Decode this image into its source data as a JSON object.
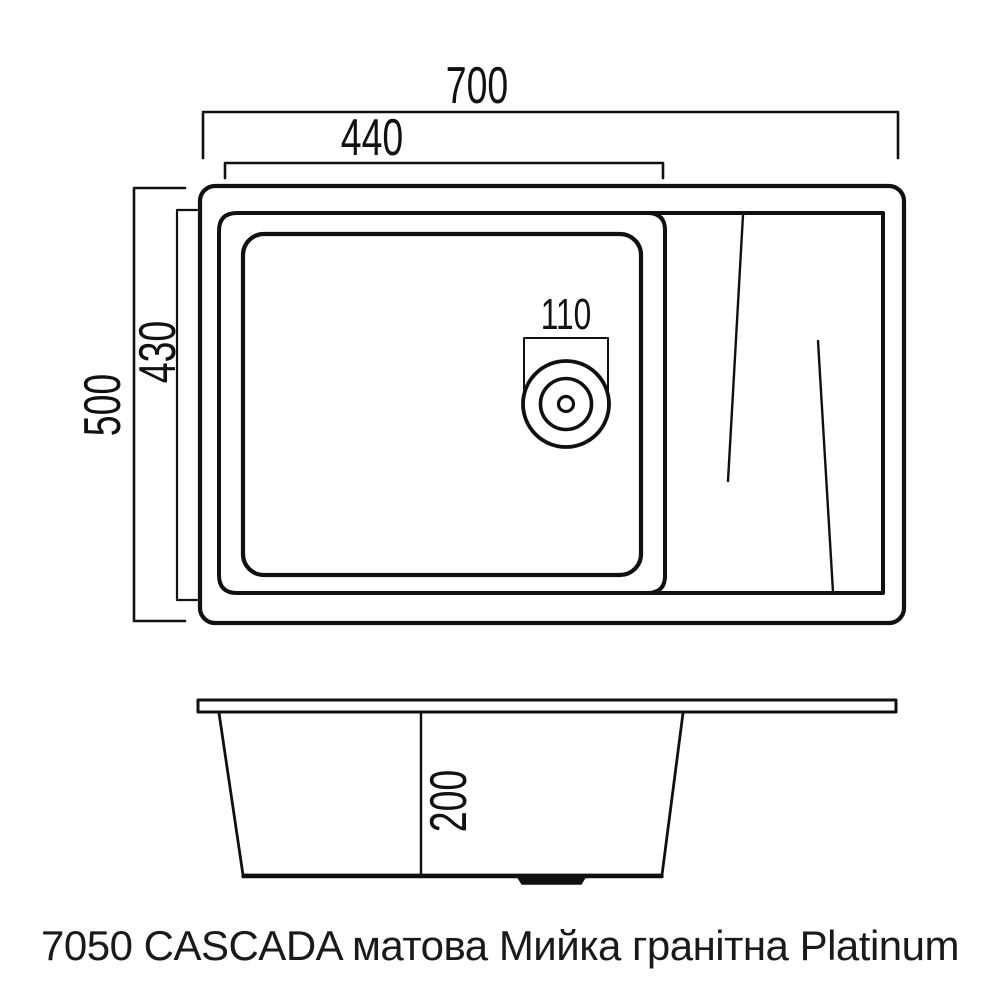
{
  "caption": "7050 CASCADA матова Мийка гранітна Platinum",
  "dimensions": {
    "total_width": "700",
    "bowl_width": "440",
    "total_depth": "500",
    "bowl_depth": "430",
    "drain_diameter": "110",
    "bowl_height": "200"
  },
  "colors": {
    "line": "#101010",
    "background": "#ffffff",
    "text": "#1a1a1a"
  }
}
